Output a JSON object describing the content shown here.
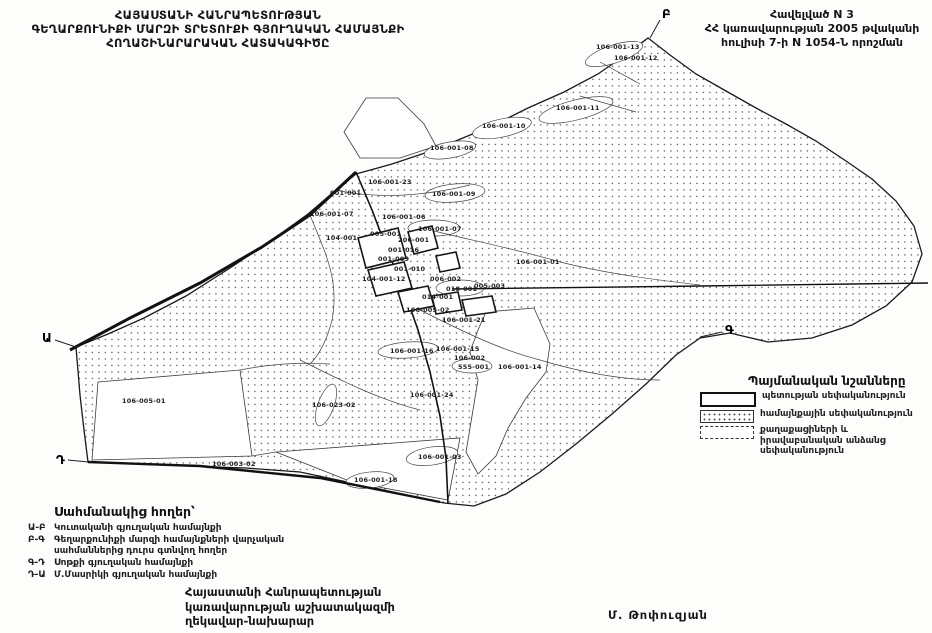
{
  "title_block": {
    "lines": [
      "ՀԱՅԱՍՏԱՆԻ ՀԱՆՐԱՊԵՏՈՒԹՅԱՆ",
      "ԳԵՂԱՐՔՈՒՆԻՔԻ ՄԱՐԶԻ ՏՐԵՏՈՒՔԻ ԳՅՈՒՂԱԿԱՆ  ՀԱՄԱՅՆՔԻ",
      "ՀՈՂԱՇԻՆԱՐԱՐԱԿԱՆ ՀԱՏԱԿԱԳԻԾԸ"
    ]
  },
  "annex_block": {
    "lines": [
      "Հավելված N 3",
      "ՀՀ կառավարության 2005 թվականի",
      "հուլիսի 7-ի N 1054-Ն  որոշման"
    ]
  },
  "legend": {
    "title": "Պայմանական նշանները",
    "items": [
      {
        "swatch": "state",
        "label": "պետության սեփականություն"
      },
      {
        "swatch": "community",
        "label": "համայնքային սեփականություն"
      },
      {
        "swatch": "private",
        "label": "քաղաքացիների և իրավաբանական անձանց սեփականություն"
      }
    ]
  },
  "border_lands": {
    "title": "Սահմանակից հողեր՝",
    "items": [
      {
        "code": "Ա-Բ",
        "label": "Կուտականի գյուղական համայնքի"
      },
      {
        "code": "Բ-Գ",
        "label": "Գեղարքունիքի մարզի համայնքների վարչական սահմաններից դուրս գտնվող հողեր"
      },
      {
        "code": "Գ-Դ",
        "label": "Սոթքի գյուղական համայնքի"
      },
      {
        "code": "Դ-Ա",
        "label": "Մ.Մասրիկի գյուղական համայնքի"
      }
    ]
  },
  "signature_block": {
    "lines": [
      "Հայաստանի Հանրապետության",
      "կառավարության աշխատակազմի",
      "ղեկավար-նախարար"
    ],
    "signer": "Մ. Թոփուզյան"
  },
  "map": {
    "corner_letters": [
      {
        "t": "Բ",
        "x": 662,
        "y": 18
      },
      {
        "t": "Ա",
        "x": 42,
        "y": 342
      },
      {
        "t": "Գ",
        "x": 725,
        "y": 334
      },
      {
        "t": "Դ",
        "x": 56,
        "y": 464
      }
    ],
    "parcel_labels": [
      {
        "t": "106-001-13",
        "x": 596,
        "y": 49
      },
      {
        "t": "106-001-12",
        "x": 614,
        "y": 60
      },
      {
        "t": "106-001-11",
        "x": 556,
        "y": 110
      },
      {
        "t": "106-001-10",
        "x": 482,
        "y": 128
      },
      {
        "t": "106-001-08",
        "x": 430,
        "y": 150
      },
      {
        "t": "106-001-23",
        "x": 368,
        "y": 184
      },
      {
        "t": "001-001",
        "x": 330,
        "y": 195
      },
      {
        "t": "106-001-09",
        "x": 432,
        "y": 196
      },
      {
        "t": "106-001-07",
        "x": 310,
        "y": 216
      },
      {
        "t": "106-001-06",
        "x": 382,
        "y": 219
      },
      {
        "t": "106-001-07",
        "x": 418,
        "y": 231
      },
      {
        "t": "005-001",
        "x": 370,
        "y": 236
      },
      {
        "t": "104-001",
        "x": 326,
        "y": 240
      },
      {
        "t": "206-001",
        "x": 398,
        "y": 242
      },
      {
        "t": "001-016",
        "x": 388,
        "y": 252
      },
      {
        "t": "106-001-01",
        "x": 516,
        "y": 264
      },
      {
        "t": "001-009",
        "x": 378,
        "y": 261
      },
      {
        "t": "001-010",
        "x": 394,
        "y": 271
      },
      {
        "t": "104-001-12",
        "x": 362,
        "y": 281
      },
      {
        "t": "006-002",
        "x": 430,
        "y": 281
      },
      {
        "t": "005-003",
        "x": 474,
        "y": 288
      },
      {
        "t": "018-001",
        "x": 446,
        "y": 291
      },
      {
        "t": "014-001",
        "x": 422,
        "y": 299
      },
      {
        "t": "106-005-02",
        "x": 406,
        "y": 312
      },
      {
        "t": "106-001-21",
        "x": 442,
        "y": 322
      },
      {
        "t": "106-001-15",
        "x": 436,
        "y": 351
      },
      {
        "t": "106-001-16",
        "x": 390,
        "y": 353
      },
      {
        "t": "106-002",
        "x": 454,
        "y": 360
      },
      {
        "t": "555-001",
        "x": 458,
        "y": 369
      },
      {
        "t": "106-001-14",
        "x": 498,
        "y": 369
      },
      {
        "t": "106-001-24",
        "x": 410,
        "y": 397
      },
      {
        "t": "106-005-01",
        "x": 122,
        "y": 403
      },
      {
        "t": "106-023-02",
        "x": 312,
        "y": 407
      },
      {
        "t": "106-003-02",
        "x": 212,
        "y": 466
      },
      {
        "t": "106-001-03",
        "x": 418,
        "y": 459
      },
      {
        "t": "106-001-18",
        "x": 354,
        "y": 482
      }
    ]
  }
}
